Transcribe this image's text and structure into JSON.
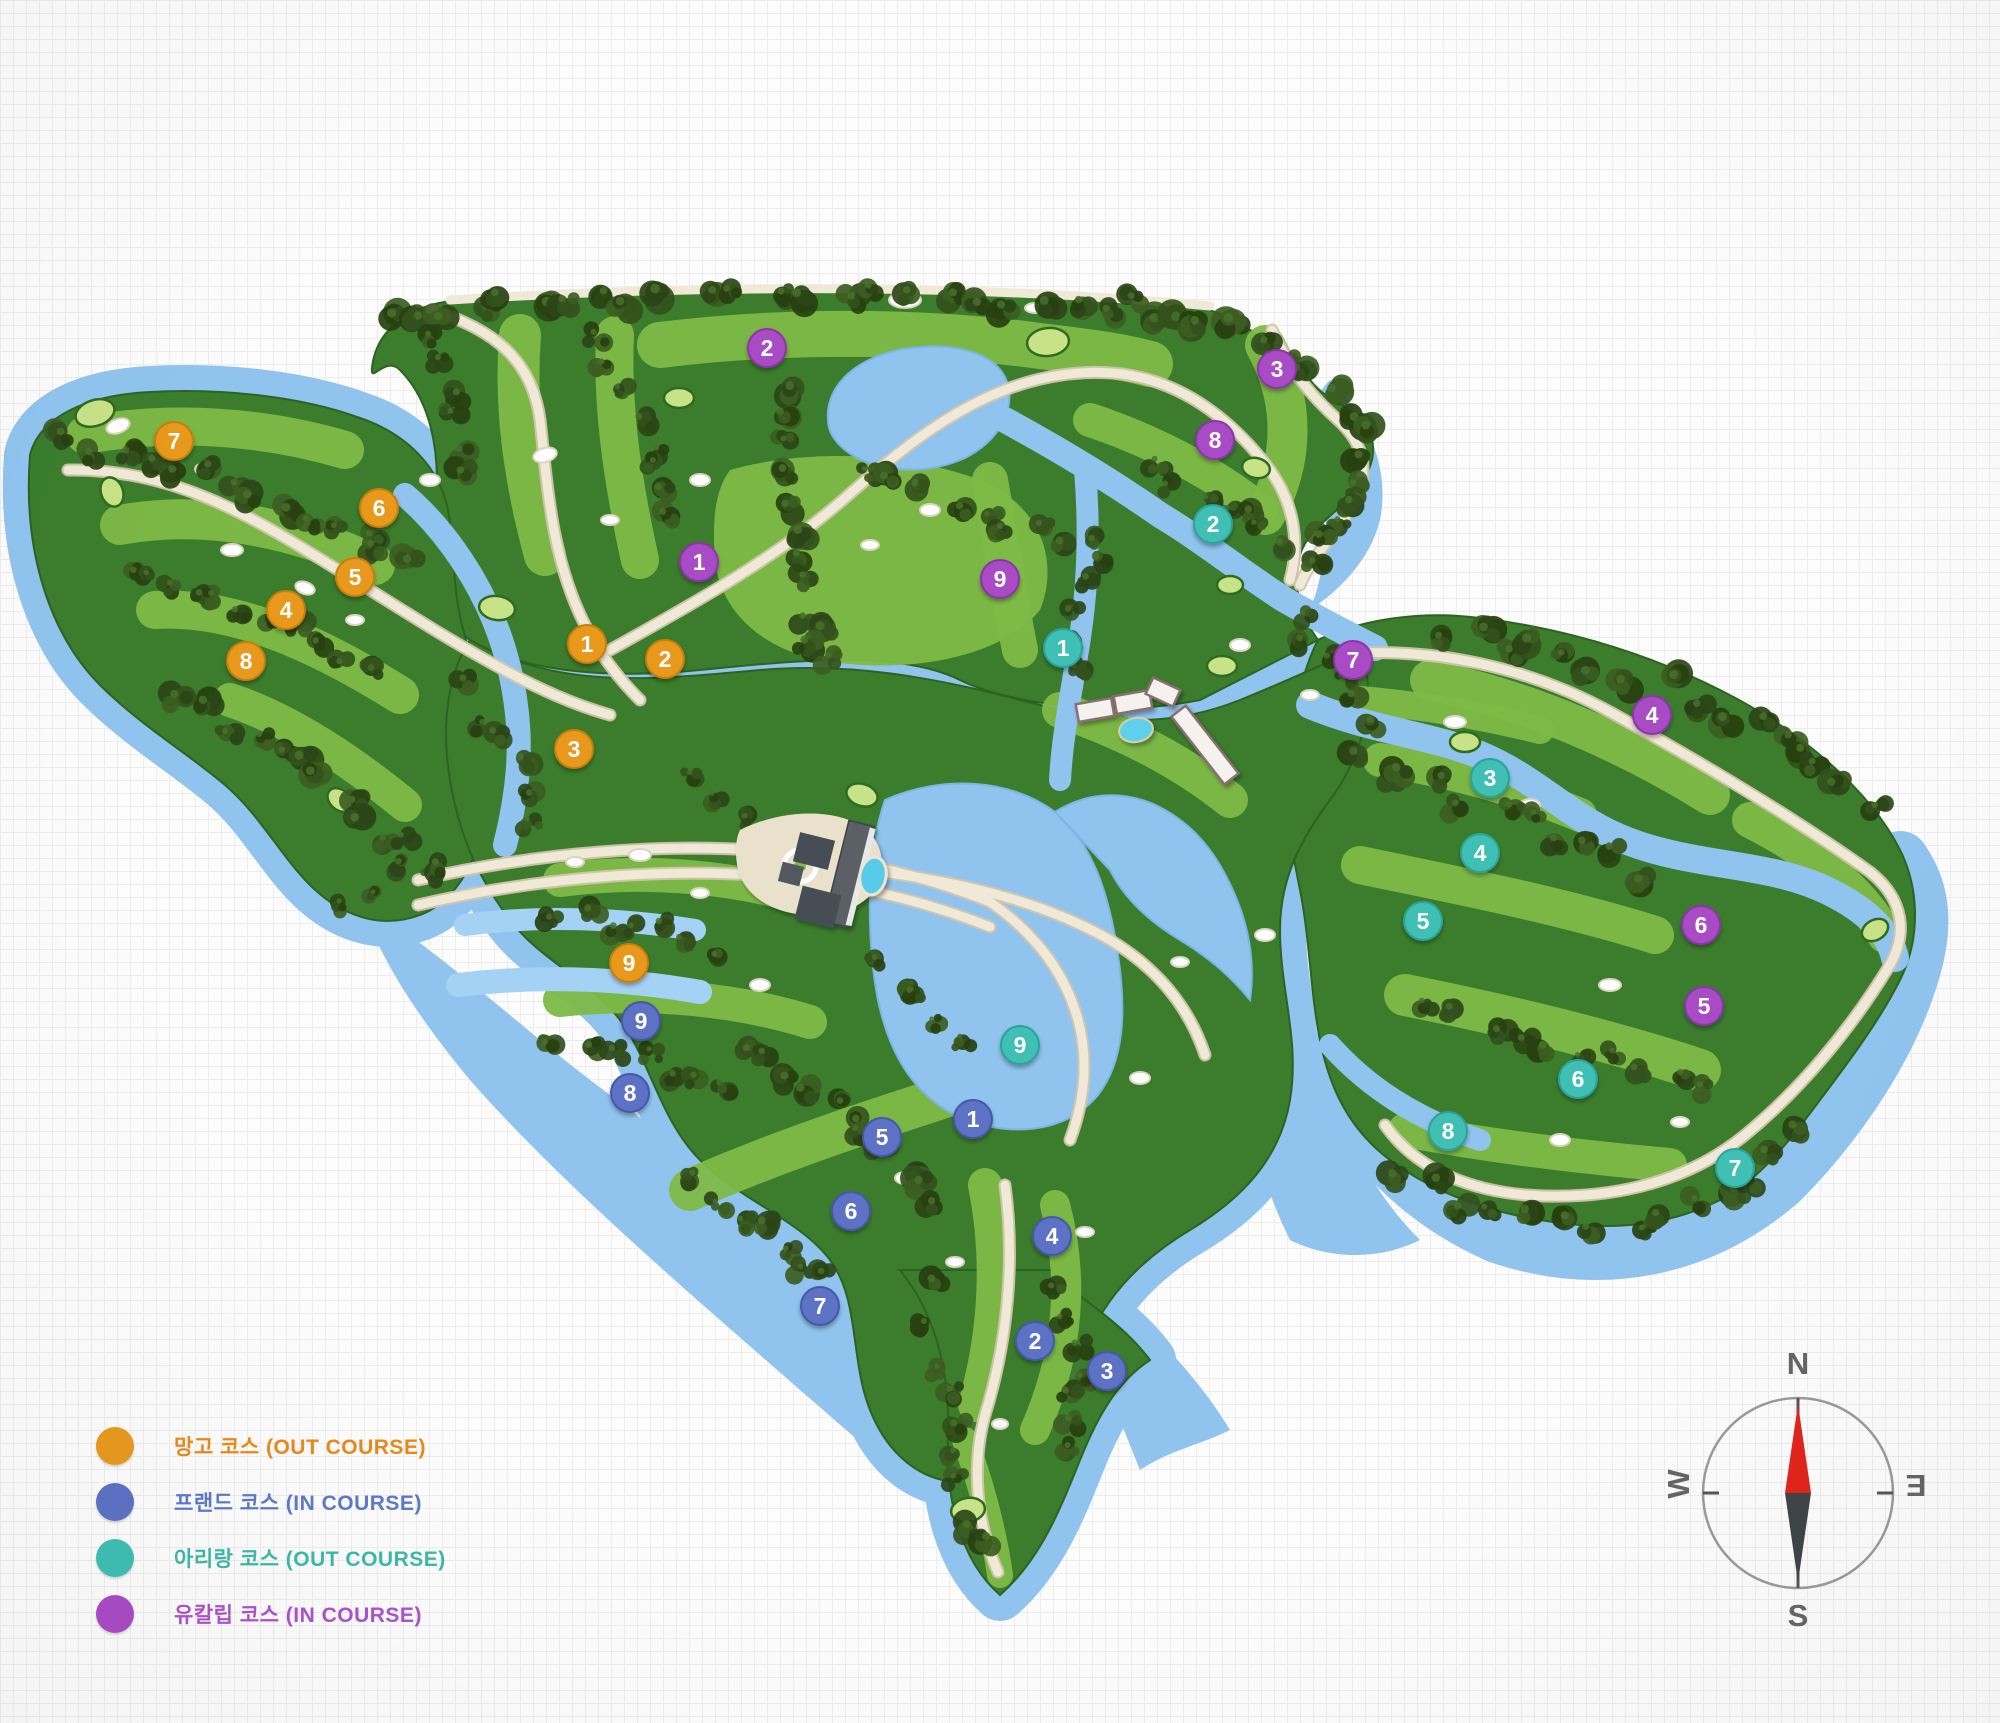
{
  "palette": {
    "land": "#3B7D2D",
    "land_edge": "#2C6320",
    "fairway": "#7EBB47",
    "pad": "#C8E287",
    "water": "#90C4EE",
    "water_deep": "#7DB5E4",
    "pond": "#A4D2F4",
    "road": "#F1E9D8",
    "road_edge": "#D2C6AC",
    "tree_colors": [
      "#33511C",
      "#2B4517",
      "#3C5D22",
      "#27400F",
      "#49702A"
    ]
  },
  "legend": {
    "items": [
      {
        "id": "mango",
        "label": "망고 코스 (OUT COURSE)",
        "color": "#E8991F",
        "text_color": "#E8891B"
      },
      {
        "id": "friend",
        "label": "프랜드 코스 (IN COURSE)",
        "color": "#5D72C5",
        "text_color": "#5E79C9"
      },
      {
        "id": "arirang",
        "label": "아리랑 코스 (OUT COURSE)",
        "color": "#3FBFB4",
        "text_color": "#3CB9A9"
      },
      {
        "id": "eucalyptus",
        "label": "유칼립 코스 (IN COURSE)",
        "color": "#A94CC5",
        "text_color": "#AC53CC"
      }
    ]
  },
  "compass": {
    "north": "N",
    "south": "S",
    "west": "W",
    "east": "E",
    "needle_north_color": "#E0251B",
    "needle_south_color": "#3F4448"
  },
  "map": {
    "marker_radius": 19,
    "courses": [
      {
        "id": "mango",
        "name": "망고 코스",
        "type": "OUT COURSE",
        "color": "#E8991F",
        "ring": "#C87E08",
        "holes": [
          {
            "n": 1,
            "x": 587,
            "y": 644
          },
          {
            "n": 2,
            "x": 665,
            "y": 659
          },
          {
            "n": 3,
            "x": 574,
            "y": 749
          },
          {
            "n": 4,
            "x": 286,
            "y": 610
          },
          {
            "n": 5,
            "x": 355,
            "y": 577
          },
          {
            "n": 6,
            "x": 379,
            "y": 508
          },
          {
            "n": 7,
            "x": 174,
            "y": 441
          },
          {
            "n": 8,
            "x": 246,
            "y": 661
          },
          {
            "n": 9,
            "x": 629,
            "y": 963
          }
        ]
      },
      {
        "id": "friend",
        "name": "프랜드 코스",
        "type": "IN COURSE",
        "color": "#5D72C5",
        "ring": "#4459A8",
        "holes": [
          {
            "n": 1,
            "x": 973,
            "y": 1119
          },
          {
            "n": 2,
            "x": 1035,
            "y": 1341
          },
          {
            "n": 3,
            "x": 1107,
            "y": 1371
          },
          {
            "n": 4,
            "x": 1052,
            "y": 1236
          },
          {
            "n": 5,
            "x": 882,
            "y": 1137
          },
          {
            "n": 6,
            "x": 851,
            "y": 1211
          },
          {
            "n": 7,
            "x": 820,
            "y": 1306
          },
          {
            "n": 8,
            "x": 630,
            "y": 1093
          },
          {
            "n": 9,
            "x": 641,
            "y": 1021
          }
        ]
      },
      {
        "id": "arirang",
        "name": "아리랑 코스",
        "type": "OUT COURSE",
        "color": "#3FBFB4",
        "ring": "#2BA39A",
        "holes": [
          {
            "n": 1,
            "x": 1063,
            "y": 648
          },
          {
            "n": 2,
            "x": 1213,
            "y": 524
          },
          {
            "n": 3,
            "x": 1490,
            "y": 778
          },
          {
            "n": 4,
            "x": 1480,
            "y": 853
          },
          {
            "n": 5,
            "x": 1423,
            "y": 921
          },
          {
            "n": 6,
            "x": 1578,
            "y": 1079
          },
          {
            "n": 7,
            "x": 1735,
            "y": 1168
          },
          {
            "n": 8,
            "x": 1448,
            "y": 1131
          },
          {
            "n": 9,
            "x": 1020,
            "y": 1045
          }
        ]
      },
      {
        "id": "eucalyptus",
        "name": "유칼립 코스",
        "type": "IN COURSE",
        "color": "#A94CC5",
        "ring": "#8C35A8",
        "holes": [
          {
            "n": 1,
            "x": 699,
            "y": 562
          },
          {
            "n": 2,
            "x": 767,
            "y": 348
          },
          {
            "n": 3,
            "x": 1277,
            "y": 369
          },
          {
            "n": 4,
            "x": 1652,
            "y": 715
          },
          {
            "n": 5,
            "x": 1704,
            "y": 1006
          },
          {
            "n": 6,
            "x": 1701,
            "y": 925
          },
          {
            "n": 7,
            "x": 1353,
            "y": 660
          },
          {
            "n": 8,
            "x": 1215,
            "y": 440
          },
          {
            "n": 9,
            "x": 1000,
            "y": 579
          }
        ]
      }
    ]
  }
}
